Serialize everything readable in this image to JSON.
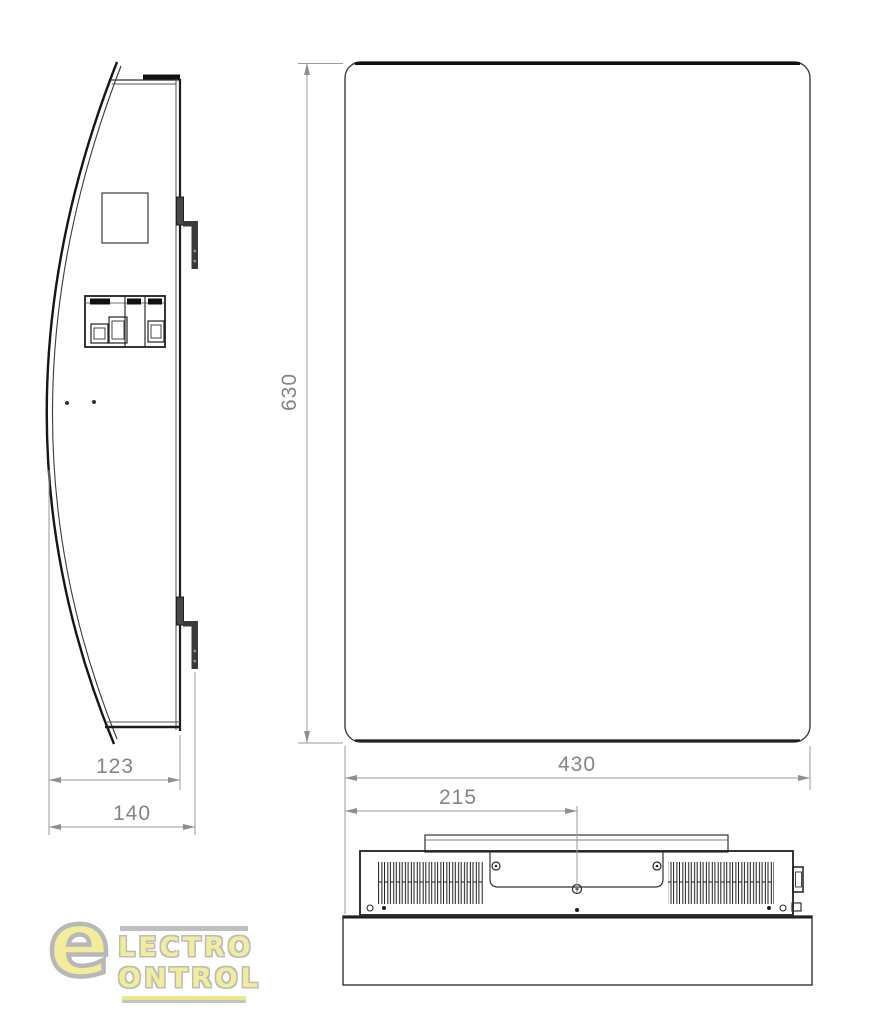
{
  "dimensions": {
    "height": "630",
    "width": "430",
    "depth_inner": "123",
    "depth_outer": "140",
    "mount_center": "215"
  },
  "logo": {
    "initial": "e",
    "line1": "LECTRO",
    "line2": "ONTROL",
    "yellow": "#f2ec96",
    "gray": "#b5b5b5"
  },
  "colors": {
    "line_dark": "#1f1f1f",
    "line_medium": "#3d3d3d",
    "dimension": "#8e8e8e",
    "background": "#ffffff"
  }
}
